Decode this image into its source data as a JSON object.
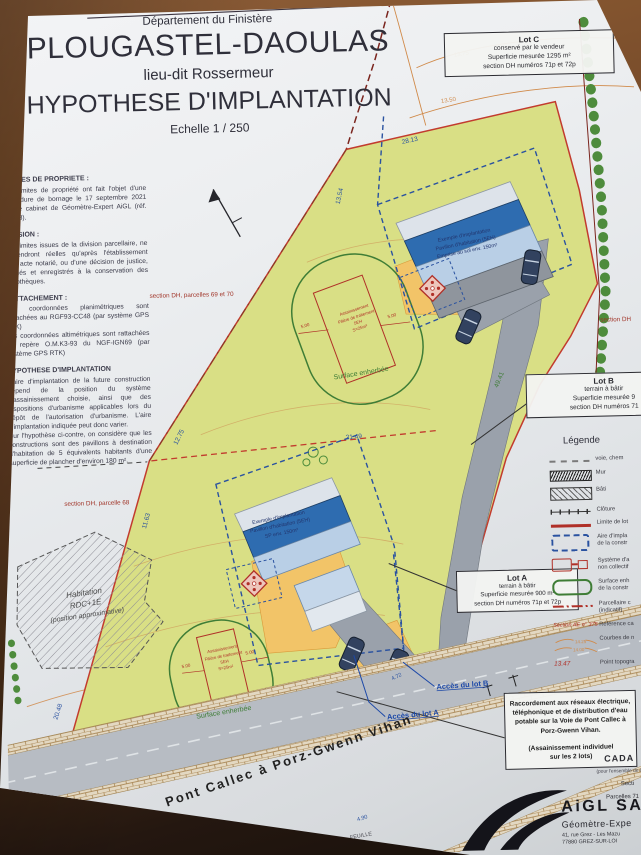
{
  "header": {
    "department": "Département du Finistère",
    "commune": "PLOUGASTEL-DAOULAS",
    "lieu_dit": "lieu-dit Rossermeur",
    "title": "HYPOTHESE D'IMPLANTATION",
    "scale": "Echelle 1 / 250"
  },
  "notes": {
    "nota": "Nota :",
    "sections": [
      {
        "heading": "LIMITES DE PROPRIETE :",
        "body": "Les limites de propriété ont fait l'objet d'une procédure de bornage le 17 septembre 2021 par le cabinet de Géomètre-Expert AiGL (réf. 21023)."
      },
      {
        "heading": "DIVISION :",
        "body": "Les limites issues de la division parcellaire, ne deviendront réelles qu'après l'établissement d'un acte notarié, ou d'une décision de justice, publiés et enregistrés à la conservation des hypothèques."
      },
      {
        "heading": "RATTACHEMENT :",
        "body": "Les coordonnées planimétriques sont rattachées au RGF93-CC48 (par système GPS RTK)\nLes coordonnées altimétriques sont rattachées au repère O.M.K3-93 du NGF-IGN69 (par système GPS RTK)"
      },
      {
        "heading": "HYPOTHESE D'IMPLANTATION",
        "body": "L'aire d'implantation de la future construction dépend de la position du système d'assainissement choisie, ainsi que des dispositions d'urbanisme applicables lors du dépôt de l'autorisation d'urbanisme. L'aire d'implantation indiquée peut donc varier.\nSur l'hypothèse ci-contre, on considère que les constructions sont des pavillons à destination d'habitation de 5 équivalents habitants d'une superficie de plancher d'environ 180 m²."
      }
    ]
  },
  "lot_boxes": {
    "lot_c": {
      "title": "Lot C",
      "line1": "conservé par le vendeur",
      "line2": "Superficie mesurée 1295 m²",
      "line3": "section DH numéros 71p et 72p"
    },
    "lot_b": {
      "title": "Lot B",
      "line1": "terrain à bâtir",
      "line2": "Superficie mesurée 9",
      "line3": "section DH numéros 71"
    },
    "lot_a": {
      "title": "Lot A",
      "line1": "terrain à bâtir",
      "line2": "Superficie mesurée 900 m²",
      "line3": "section DH numéros 71p et 72p"
    },
    "raccordement": {
      "body": "Raccordement aux réseaux électrique, téléphonique et de distribution d'eau potable sur la Voie de Pont Callec à Porz-Gwenn Vihan.",
      "note": "(Assainissement individuel\nsur les 2 lots)"
    }
  },
  "legend": {
    "title": "Légende",
    "items": [
      {
        "icon": "dashed-gray-line",
        "label": "voie, chem"
      },
      {
        "icon": "wall-hatch",
        "label": "Mur"
      },
      {
        "icon": "building-hatch",
        "label": "Bâti"
      },
      {
        "icon": "fence-line",
        "label": "Clôture"
      },
      {
        "icon": "red-line",
        "label": "Limite de lot"
      },
      {
        "icon": "blue-dashed-rect",
        "label": "Aire d'impla\nde la constr"
      },
      {
        "icon": "red-septic-shapes",
        "label": "Système d'a\nnon collectif"
      },
      {
        "icon": "green-rounded-rect",
        "label": "Surface enh\nde la constr"
      },
      {
        "icon": "red-dashdot-line",
        "label": "Parcellaire c\n(indicatif)"
      },
      {
        "icon": "cadastral-ref-text",
        "swatch_text": "Section AE n° 375",
        "label": "Référence ca"
      },
      {
        "icon": "contour-lines",
        "swatch_top": "14.25",
        "swatch_bottom": "14.00",
        "label": "Courbes de n"
      },
      {
        "icon": "topo-point-text",
        "swatch_text": "13.47",
        "label": "Point topogra"
      }
    ]
  },
  "plan": {
    "section_69_70": "section DH, parcelles 69 et 70",
    "section_68": "section DH, parcelle 68",
    "section_right": "section DH",
    "building_upper": [
      "Exemple d'implantation",
      "Pavillon d'habitation (5EH)",
      "Emprise au sol env. 150m²"
    ],
    "building_lower": [
      "Exemple d'implantation",
      "Pavillon d'habitation (5EH)",
      "SP env. 150m²"
    ],
    "septic": [
      "Assainissement",
      "Filière de traitement",
      "5EH",
      "S=25m²"
    ],
    "surface_grass": "Surface enherbée",
    "existing_house": [
      "Habitation",
      "RDC+1E",
      "(position approximative)"
    ],
    "access_b": "Accès du lot B",
    "access_a": "Accès du lot A",
    "road_name": "Pont Callec à Porz-Gwenn Vihan",
    "dims": {
      "top_width": "28.13",
      "upper_left": "13.54",
      "contour_hi": "13.75",
      "contour_lo": "13.50",
      "mid_left": "12.75",
      "low_left": "11.63",
      "bottom_left": "20.48",
      "driveway": "49.41",
      "ab_boundary": "21.49",
      "access_width": "4.72",
      "road_width": "4.90",
      "septic_side": "5.00"
    }
  },
  "footer": {
    "cadastre_title": "CADA",
    "cadastre_sub": "(pour l'ensemble de la p",
    "cadastre_section": "Secti",
    "cadastre_parcels": "Parcelles 71",
    "sheet": "FEUILLE",
    "firm_name": "AiGL SA",
    "firm_role": "Géomètre-Expe",
    "firm_addr1": "41, rue Grez - Les Mazu",
    "firm_addr2": "77880 GREZ-SUR-LOI"
  },
  "colors": {
    "lot_fill": "#d9df85",
    "limit_red": "#c23b2e",
    "dim_blue": "#2a52a0",
    "contour_orange": "#d08a4a",
    "grass_green": "#3f7d36",
    "roof_blue": "#2e6cb0",
    "driveway_gray": "#9aa1ab"
  }
}
